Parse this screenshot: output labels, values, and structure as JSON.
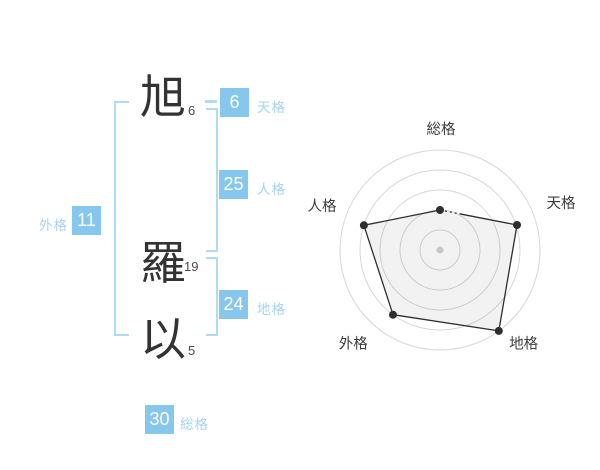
{
  "name_panel": {
    "characters": [
      {
        "char": "旭",
        "strokes": "6"
      },
      {
        "char": "羅",
        "strokes": "19"
      },
      {
        "char": "以",
        "strokes": "5"
      }
    ],
    "badges": [
      {
        "id": "tenkaku",
        "value": "6",
        "label": "天格"
      },
      {
        "id": "jinkaku",
        "value": "25",
        "label": "人格"
      },
      {
        "id": "chikaku",
        "value": "24",
        "label": "地格"
      },
      {
        "id": "gaikaku",
        "value": "11",
        "label": "外格"
      },
      {
        "id": "soukaku",
        "value": "30",
        "label": "総格"
      }
    ],
    "colors": {
      "badge_bg": "#87c7ee",
      "badge_text": "#ffffff",
      "label_text": "#a6d3f1",
      "bracket": "#aedcf7",
      "kanji": "#333333",
      "stroke_number": "#4a4a4a"
    }
  },
  "chart_data": {
    "type": "radar",
    "title": "",
    "axes": [
      "総格",
      "天格",
      "地格",
      "外格",
      "人格"
    ],
    "axis_stroke_values": {
      "総格": 30,
      "天格": 6,
      "地格": 24,
      "外格": 11,
      "人格": 25
    },
    "series": [
      {
        "name": "fortune-score",
        "values_fraction": [
          0.4,
          0.81,
          1.0,
          0.8,
          0.8
        ],
        "scores_of_5": [
          2,
          4,
          5,
          4,
          4
        ]
      }
    ],
    "rings": 5,
    "ring_values": [
      1,
      2,
      3,
      4,
      5
    ],
    "grid": "circular",
    "legend": "none",
    "dashed_segment": {
      "from_axis": "総格",
      "to_axis": "天格",
      "length_px": 20
    },
    "colors": {
      "grid": "#d7d7d7",
      "line": "#2e2e2e",
      "point": "#2e2e2e",
      "fill": "rgba(0,0,0,0.05)",
      "center_dot": "#c7c7c7",
      "label": "#3c3c3c"
    }
  }
}
